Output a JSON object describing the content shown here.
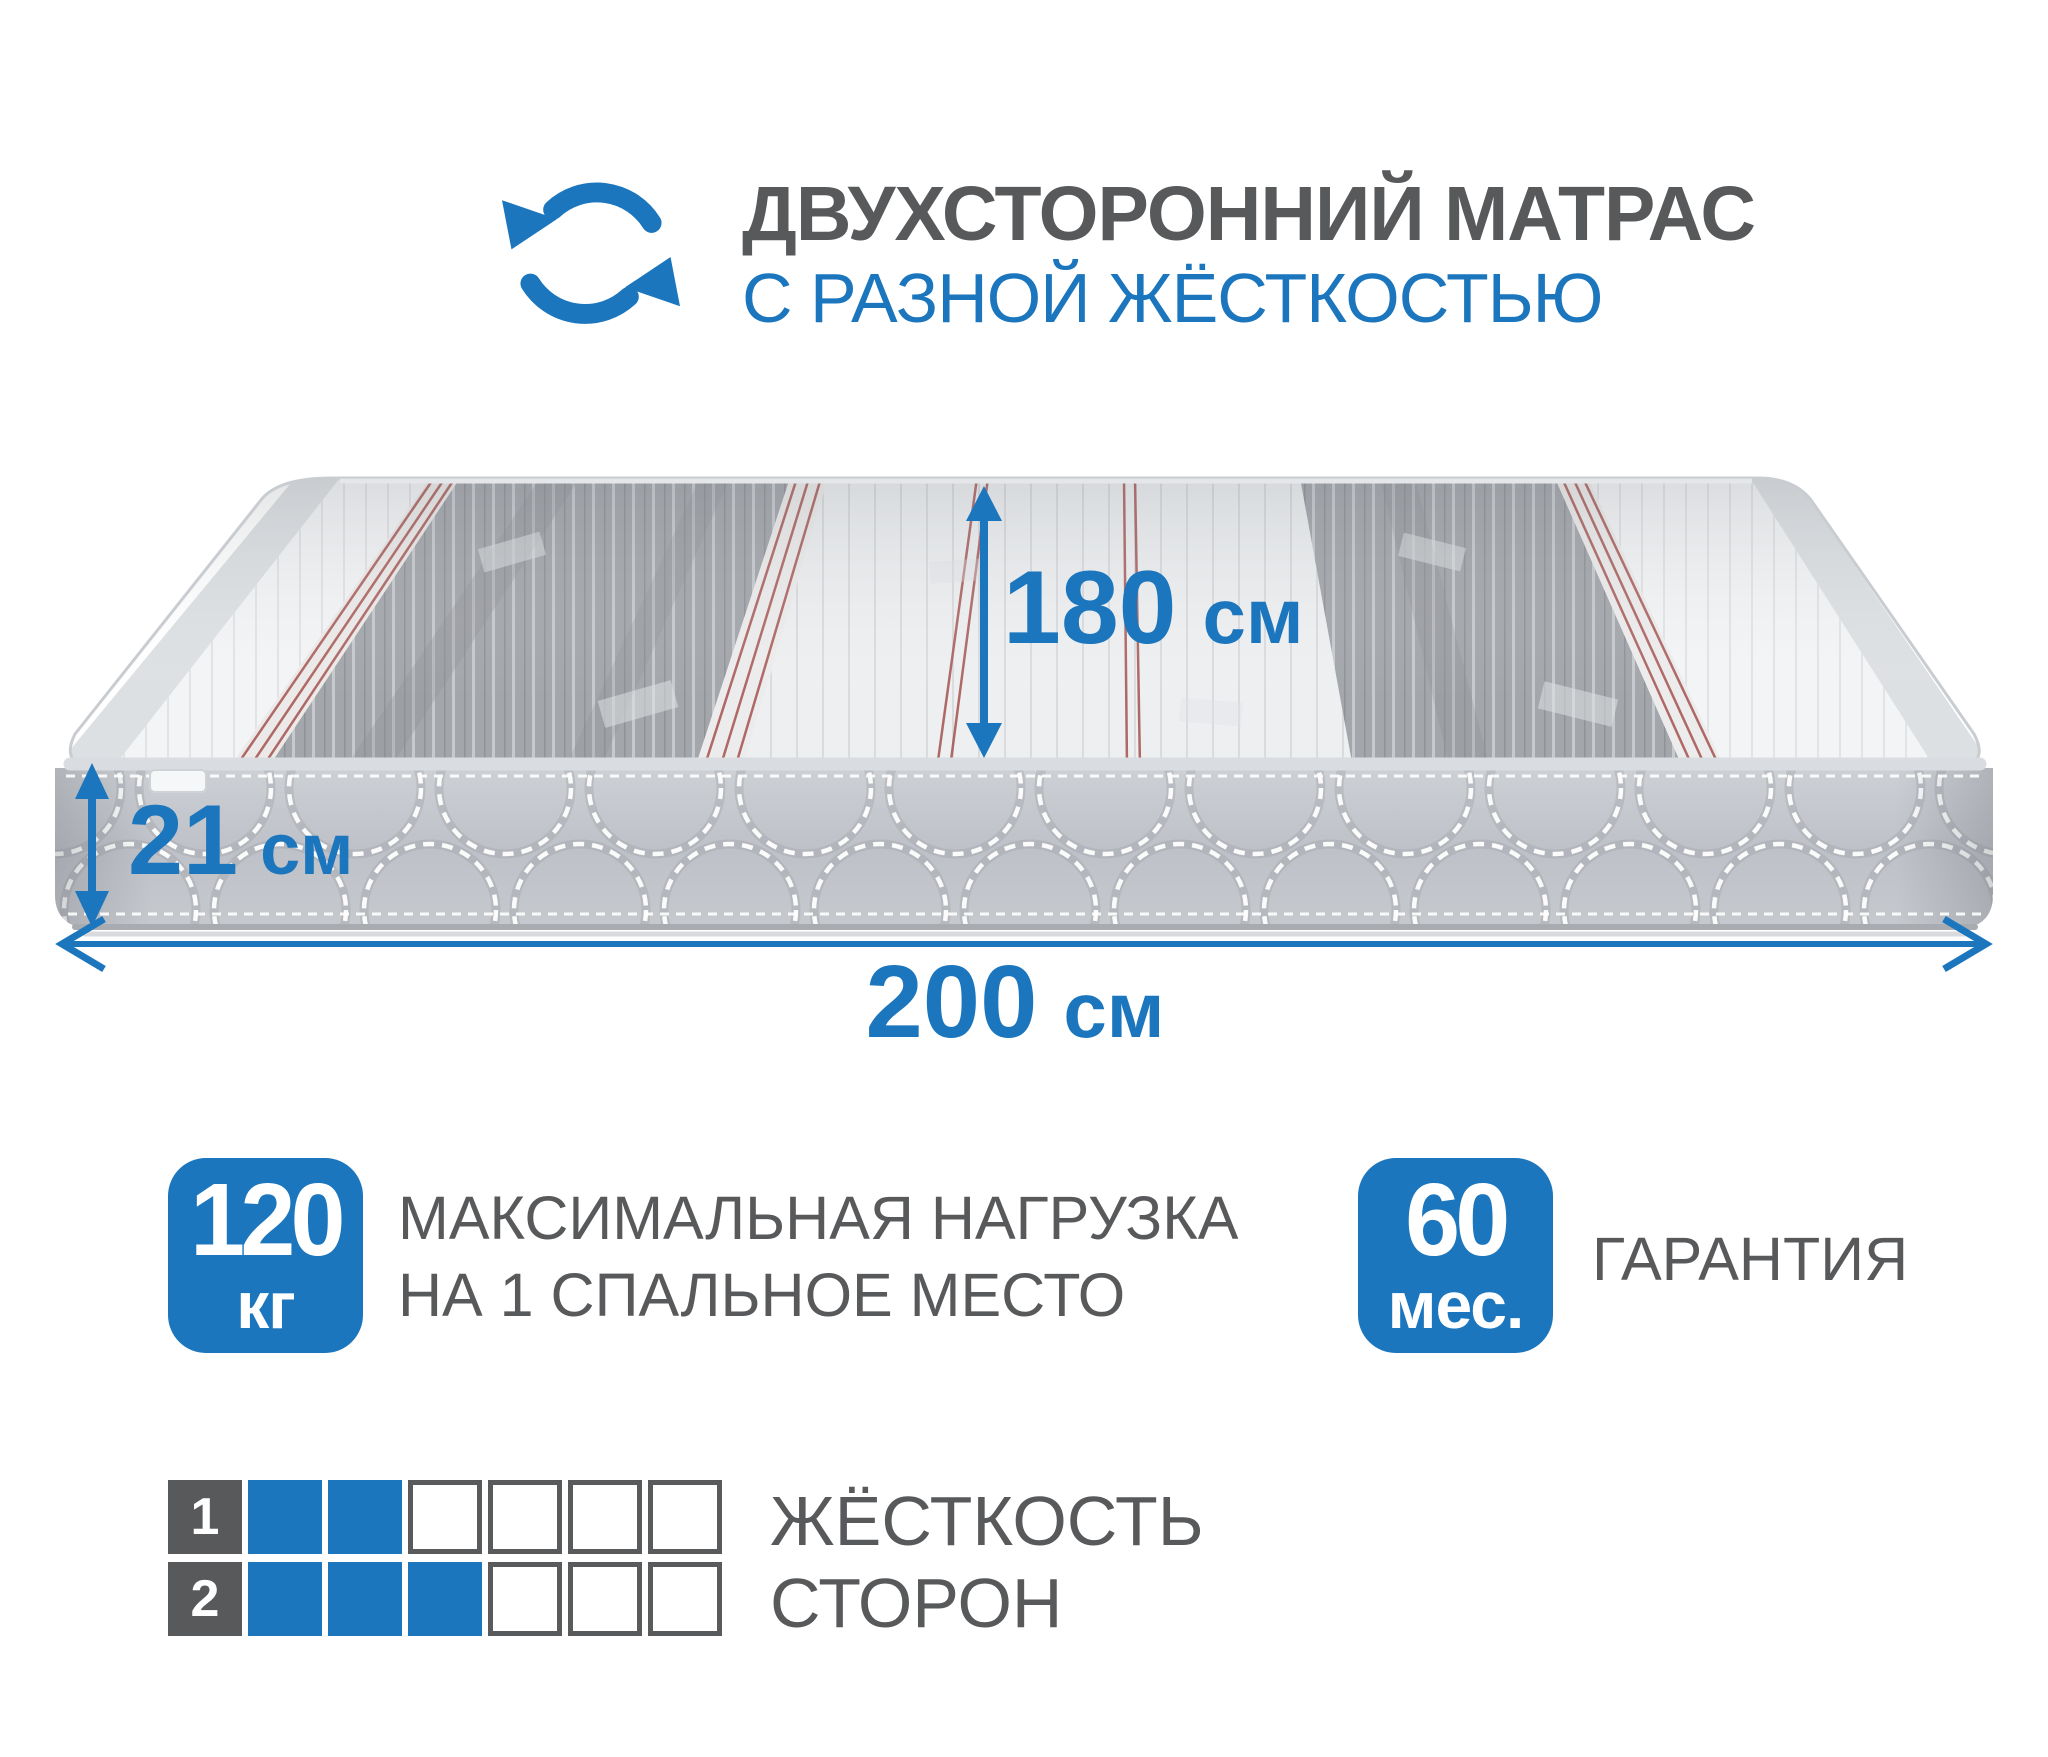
{
  "header": {
    "title_line1": "ДВУХСТОРОННИЙ МАТРАС",
    "title_line2": "С РАЗНОЙ ЖЁСТКОСТЬЮ",
    "icon": "rotate-arrows-icon"
  },
  "dimensions": {
    "depth": {
      "value": "180",
      "unit": "см"
    },
    "thickness": {
      "value": "21",
      "unit": "см"
    },
    "length": {
      "value": "200",
      "unit": "см"
    }
  },
  "badge_load": {
    "value": "120",
    "unit": "кг",
    "label_line1": "МАКСИМАЛЬНАЯ НАГРУЗКА",
    "label_line2": "НА 1 СПАЛЬНОЕ МЕСТО"
  },
  "badge_warranty": {
    "value": "60",
    "unit": "мес.",
    "label": "ГАРАНТИЯ"
  },
  "hardness": {
    "label_line1": "ЖЁСТКОСТЬ",
    "label_line2": "СТОРОН",
    "rows": [
      {
        "side": "1",
        "filled": 2,
        "total": 6
      },
      {
        "side": "2",
        "filled": 3,
        "total": 6
      }
    ]
  },
  "colors": {
    "accent_blue": "#1b76bd",
    "text_gray": "#58595b",
    "red_pinstripe": "#a85a58",
    "mattress_dark_band": "#a3a6ab",
    "mattress_light_band": "#edeff1",
    "mattress_front": "#c2c5cb"
  }
}
